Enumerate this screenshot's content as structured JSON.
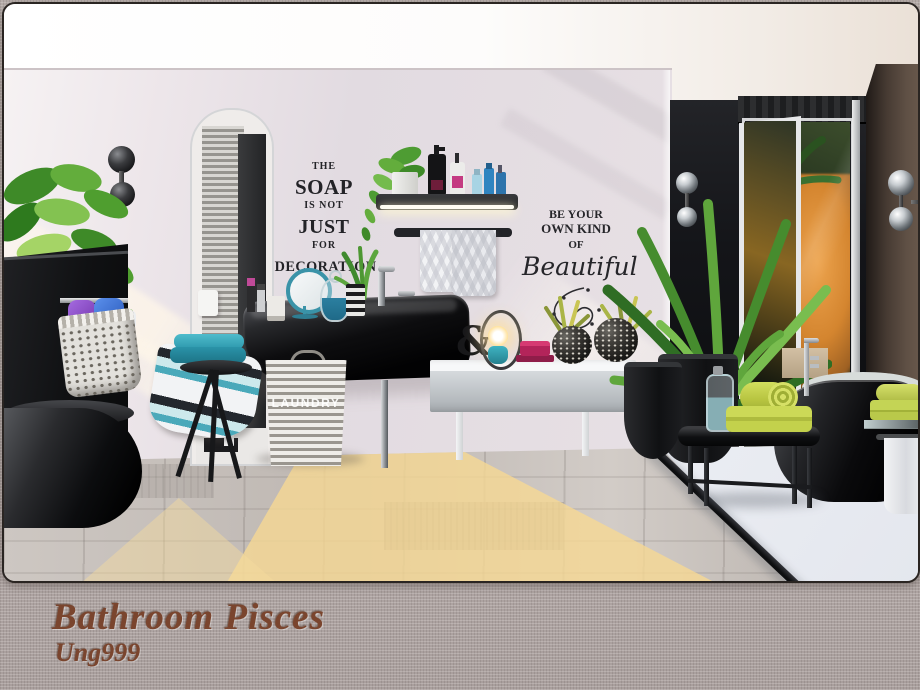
{
  "caption": {
    "title": "Bathroom Pisces",
    "author": "Ung999"
  },
  "scene": {
    "decal_soap": {
      "lines": [
        "THE",
        "SOAP",
        "IS NOT",
        "JUST",
        "FOR",
        "DECORATION"
      ]
    },
    "decal_beautiful": {
      "lines": [
        "BE YOUR",
        "OWN KIND",
        "OF"
      ],
      "script": "Beautiful"
    },
    "laundry_label": "LAUNDRY",
    "ampersand": "&"
  },
  "palette": {
    "wall": "#e2dbe1",
    "wall_bright": "#f6f2f3",
    "black_wall": "#141519",
    "brown_wall": "#55463c",
    "ceiling": "#fdfcfb",
    "wood_floor": "#c7c1bc",
    "tile_floor": "#e9ebf0",
    "sunlight": "#f6d894",
    "teal_accent": "#2f9fb4",
    "lime_accent": "#c0cf48",
    "pink_accent": "#c02760",
    "plant_green": "#4d9733",
    "decal_text": "#232327",
    "caption_text": "#7a452e",
    "linen": "#b2a8a6"
  }
}
